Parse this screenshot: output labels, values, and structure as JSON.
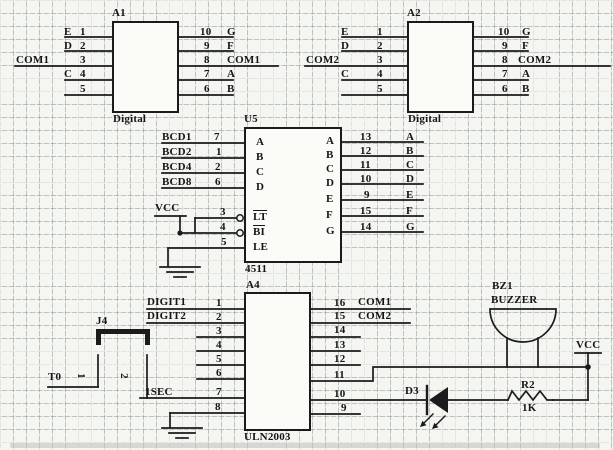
{
  "palette": {
    "ink": "#1b1b1b",
    "paper": "#f5f5f1",
    "grid": "#748880"
  },
  "a1": {
    "ref": "A1",
    "footer": "Digital",
    "left": [
      {
        "net": "E",
        "pin": "1"
      },
      {
        "net": "D",
        "pin": "2"
      },
      {
        "net": "COM1",
        "pin": "3"
      },
      {
        "net": "C",
        "pin": "4"
      },
      {
        "net": "",
        "pin": "5"
      }
    ],
    "right": [
      {
        "pin": "10",
        "net": "G"
      },
      {
        "pin": "9",
        "net": "F"
      },
      {
        "pin": "8",
        "net": "COM1"
      },
      {
        "pin": "7",
        "net": "A"
      },
      {
        "pin": "6",
        "net": "B"
      }
    ]
  },
  "a2": {
    "ref": "A2",
    "footer": "Digital",
    "left": [
      {
        "net": "E",
        "pin": "1"
      },
      {
        "net": "D",
        "pin": "2"
      },
      {
        "net": "COM2",
        "pin": "3"
      },
      {
        "net": "C",
        "pin": "4"
      },
      {
        "net": "",
        "pin": "5"
      }
    ],
    "right": [
      {
        "pin": "10",
        "net": "G"
      },
      {
        "pin": "9",
        "net": "F"
      },
      {
        "pin": "8",
        "net": "COM2"
      },
      {
        "pin": "7",
        "net": "A"
      },
      {
        "pin": "6",
        "net": "B"
      }
    ]
  },
  "u5": {
    "ref": "U5",
    "part": "4511",
    "inputs": [
      {
        "net": "BCD1",
        "pin": "7",
        "port": "A"
      },
      {
        "net": "BCD2",
        "pin": "1",
        "port": "B"
      },
      {
        "net": "BCD4",
        "pin": "2",
        "port": "C"
      },
      {
        "net": "BCD8",
        "pin": "6",
        "port": "D"
      }
    ],
    "controls": [
      {
        "pin": "3",
        "port": "LT"
      },
      {
        "pin": "4",
        "port": "BI"
      },
      {
        "pin": "5",
        "port": "LE"
      }
    ],
    "outputs": [
      {
        "pin": "13",
        "net": "A",
        "port": "A"
      },
      {
        "pin": "12",
        "net": "B",
        "port": "B"
      },
      {
        "pin": "11",
        "net": "C",
        "port": "C"
      },
      {
        "pin": "10",
        "net": "D",
        "port": "D"
      },
      {
        "pin": "9",
        "net": "E",
        "port": "E"
      },
      {
        "pin": "15",
        "net": "F",
        "port": "F"
      },
      {
        "pin": "14",
        "net": "G",
        "port": "G"
      }
    ]
  },
  "a4": {
    "ref": "A4",
    "part": "ULN2003",
    "left": [
      {
        "net": "DIGIT1",
        "pin": "1"
      },
      {
        "net": "DIGIT2",
        "pin": "2"
      },
      {
        "net": "",
        "pin": "3"
      },
      {
        "net": "",
        "pin": "4"
      },
      {
        "net": "",
        "pin": "5"
      },
      {
        "net": "",
        "pin": "6"
      },
      {
        "net": "1SEC",
        "pin": "7"
      },
      {
        "net": "",
        "pin": "8"
      }
    ],
    "right": [
      {
        "pin": "16",
        "net": "COM1"
      },
      {
        "pin": "15",
        "net": "COM2"
      },
      {
        "pin": "14",
        "net": ""
      },
      {
        "pin": "13",
        "net": ""
      },
      {
        "pin": "12",
        "net": ""
      },
      {
        "pin": "11",
        "net": ""
      },
      {
        "pin": "10",
        "net": ""
      },
      {
        "pin": "9",
        "net": ""
      }
    ]
  },
  "j4": {
    "ref": "J4",
    "pin1": "1",
    "pin2": "2"
  },
  "nets": {
    "t0": "T0"
  },
  "bz1": {
    "ref": "BZ1",
    "type": "BUZZER"
  },
  "d3": {
    "ref": "D3"
  },
  "r2": {
    "ref": "R2",
    "value": "1K"
  },
  "vcc": "VCC"
}
